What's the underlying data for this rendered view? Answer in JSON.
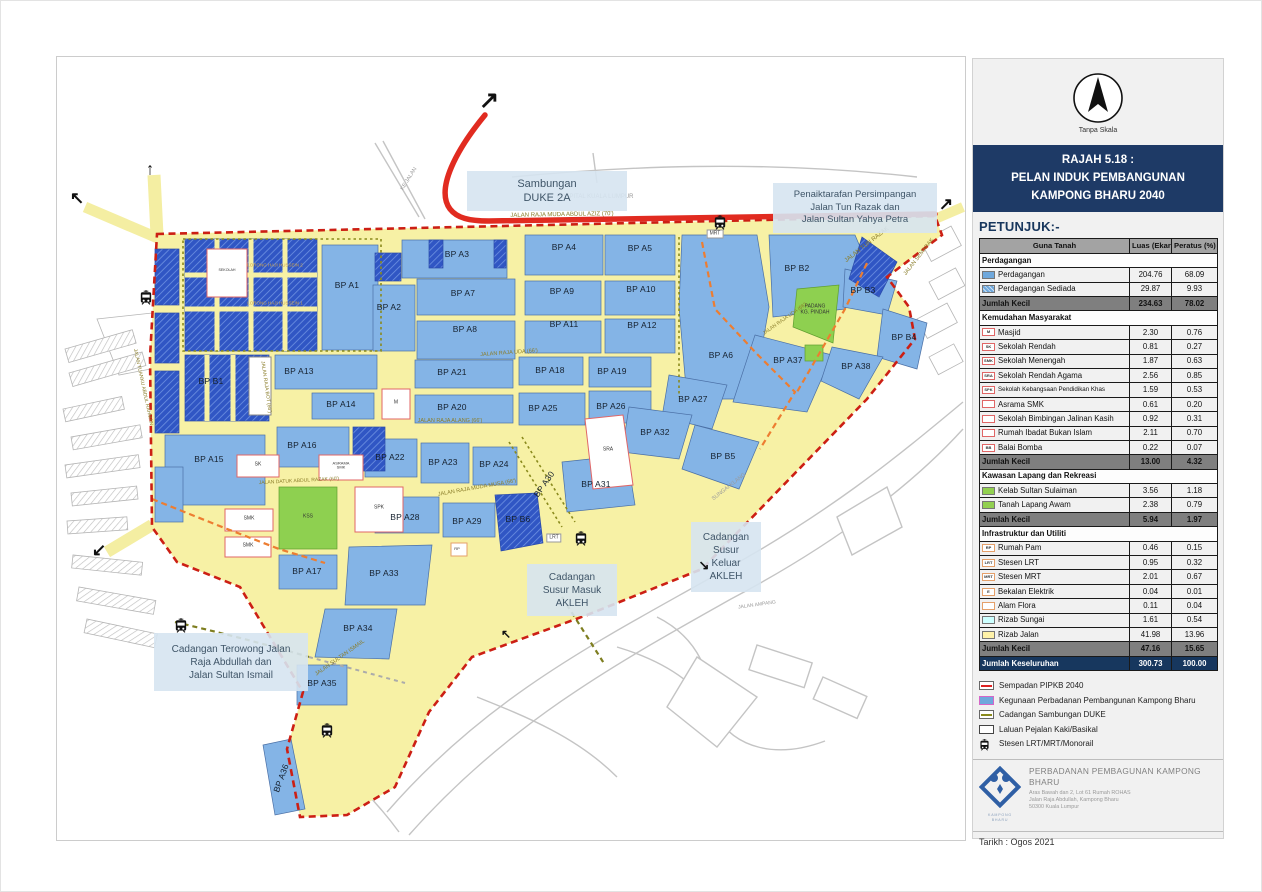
{
  "panel": {
    "scale_note": "Tanpa Skala",
    "title_lines": [
      "RAJAH 5.18 :",
      "PELAN INDUK PEMBANGUNAN",
      "KAMPONG BHARU 2040"
    ],
    "legend_heading": "PETUNJUK:-",
    "table": {
      "headers": [
        "Guna Tanah",
        "Luas (Ekar)",
        "Peratus (%)"
      ],
      "rows": [
        {
          "type": "section",
          "label": "Perdagangan"
        },
        {
          "type": "item",
          "swatch": {
            "style": "solid",
            "color": "#6fa8dc"
          },
          "label": "Perdagangan",
          "luas": "204.76",
          "peratus": "68.09"
        },
        {
          "type": "item",
          "swatch": {
            "style": "hatch",
            "color": "#6fa8dc"
          },
          "label": "Perdagangan Sediada",
          "luas": "29.87",
          "peratus": "9.93"
        },
        {
          "type": "subtotal",
          "label": "Jumlah Kecil",
          "luas": "234.63",
          "peratus": "78.02"
        },
        {
          "type": "section",
          "label": "Kemudahan Masyarakat"
        },
        {
          "type": "item",
          "swatch": {
            "style": "box",
            "border": "#e06666",
            "text": "M"
          },
          "label": "Masjid",
          "luas": "2.30",
          "peratus": "0.76"
        },
        {
          "type": "item",
          "swatch": {
            "style": "box",
            "border": "#e06666",
            "text": "SK"
          },
          "label": "Sekolah Rendah",
          "luas": "0.81",
          "peratus": "0.27"
        },
        {
          "type": "item",
          "swatch": {
            "style": "box",
            "border": "#e06666",
            "text": "SMK"
          },
          "label": "Sekolah Menengah",
          "luas": "1.87",
          "peratus": "0.63"
        },
        {
          "type": "item",
          "swatch": {
            "style": "box",
            "border": "#e06666",
            "text": "SRA"
          },
          "label": "Sekolah Rendah Agama",
          "luas": "2.56",
          "peratus": "0.85"
        },
        {
          "type": "item",
          "swatch": {
            "style": "box",
            "border": "#e06666",
            "text": "SPK"
          },
          "label": "Sekolah Kebangsaan Pendidikan Khas",
          "small": true,
          "luas": "1.59",
          "peratus": "0.53"
        },
        {
          "type": "item",
          "swatch": {
            "style": "box",
            "border": "#e06666",
            "text": ""
          },
          "label": "Asrama SMK",
          "luas": "0.61",
          "peratus": "0.20"
        },
        {
          "type": "item",
          "swatch": {
            "style": "box",
            "border": "#e06666",
            "text": ""
          },
          "label": "Sekolah Bimbingan Jalinan Kasih",
          "luas": "0.92",
          "peratus": "0.31"
        },
        {
          "type": "item",
          "swatch": {
            "style": "box",
            "border": "#e06666",
            "text": ""
          },
          "label": "Rumah Ibadat Bukan Islam",
          "luas": "2.11",
          "peratus": "0.70"
        },
        {
          "type": "item",
          "swatch": {
            "style": "box",
            "border": "#e06666",
            "text": "BB"
          },
          "label": "Balai Bomba",
          "luas": "0.22",
          "peratus": "0.07"
        },
        {
          "type": "subtotal",
          "label": "Jumlah Kecil",
          "luas": "13.00",
          "peratus": "4.32"
        },
        {
          "type": "section",
          "label": "Kawasan Lapang dan Rekreasi"
        },
        {
          "type": "item",
          "swatch": {
            "style": "solid",
            "color": "#92d050"
          },
          "label": "Kelab Sultan Sulaiman",
          "luas": "3.56",
          "peratus": "1.18"
        },
        {
          "type": "item",
          "swatch": {
            "style": "solid",
            "color": "#92d050"
          },
          "label": "Tanah Lapang Awam",
          "luas": "2.38",
          "peratus": "0.79"
        },
        {
          "type": "subtotal",
          "label": "Jumlah Kecil",
          "luas": "5.94",
          "peratus": "1.97"
        },
        {
          "type": "section",
          "label": "Infrastruktur dan Utiliti"
        },
        {
          "type": "item",
          "swatch": {
            "style": "box",
            "border": "#e5a06a",
            "text": "RP"
          },
          "label": "Rumah Pam",
          "luas": "0.46",
          "peratus": "0.15"
        },
        {
          "type": "item",
          "swatch": {
            "style": "box",
            "border": "#e5a06a",
            "text": "LRT"
          },
          "label": "Stesen LRT",
          "luas": "0.95",
          "peratus": "0.32"
        },
        {
          "type": "item",
          "swatch": {
            "style": "box",
            "border": "#e5a06a",
            "text": "MRT"
          },
          "label": "Stesen MRT",
          "luas": "2.01",
          "peratus": "0.67"
        },
        {
          "type": "item",
          "swatch": {
            "style": "box",
            "border": "#e5a06a",
            "text": "E"
          },
          "label": "Bekalan Elektrik",
          "luas": "0.04",
          "peratus": "0.01"
        },
        {
          "type": "item",
          "swatch": {
            "style": "box",
            "border": "#e5a06a",
            "text": ""
          },
          "label": "Alam Flora",
          "luas": "0.11",
          "peratus": "0.04"
        },
        {
          "type": "item",
          "swatch": {
            "style": "solid",
            "color": "#ccffff"
          },
          "label": "Rizab Sungai",
          "luas": "1.61",
          "peratus": "0.54"
        },
        {
          "type": "item",
          "swatch": {
            "style": "solid",
            "color": "#fff2a8"
          },
          "label": "Rizab Jalan",
          "luas": "41.98",
          "peratus": "13.96"
        },
        {
          "type": "subtotal",
          "label": "Jumlah Kecil",
          "luas": "47.16",
          "peratus": "15.65"
        },
        {
          "type": "total",
          "label": "Jumlah Keseluruhan",
          "luas": "300.73",
          "peratus": "100.00"
        }
      ]
    },
    "symbols": [
      {
        "icon": "dash-red",
        "label": "Sempadan PIPKB 2040"
      },
      {
        "icon": "fill-blue",
        "label": "Kegunaan Perbadanan Pembangunan Kampong Bharu"
      },
      {
        "icon": "dash-olive",
        "label": "Cadangan Sambungan DUKE"
      },
      {
        "icon": "white-box",
        "label": "Laluan Pejalan Kaki/Basikal"
      },
      {
        "icon": "train",
        "label": "Stesen LRT/MRT/Monorail"
      }
    ],
    "org": {
      "name": "PERBADANAN PEMBAGUNAN KAMPONG BHARU",
      "address_lines": [
        "Aras Bawah dan 2, Lot 61 Rumah ROHAS",
        "Jalan Raja Abdullah, Kampong Bharu",
        "50300 Kuala Lumpur"
      ],
      "logo_sub": "KAMPONG BHARU"
    },
    "date_label": "Tarikh : Ogos 2021"
  },
  "map": {
    "zones": [
      {
        "label": "BP A1",
        "x": 290,
        "y": 228
      },
      {
        "label": "BP A2",
        "x": 332,
        "y": 250
      },
      {
        "label": "BP A3",
        "x": 400,
        "y": 197
      },
      {
        "label": "BP A4",
        "x": 507,
        "y": 190
      },
      {
        "label": "BP A5",
        "x": 583,
        "y": 191
      },
      {
        "label": "BP A6",
        "x": 664,
        "y": 298
      },
      {
        "label": "BP A7",
        "x": 406,
        "y": 236
      },
      {
        "label": "BP A8",
        "x": 408,
        "y": 272
      },
      {
        "label": "BP A9",
        "x": 505,
        "y": 234
      },
      {
        "label": "BP A10",
        "x": 584,
        "y": 232
      },
      {
        "label": "BP A11",
        "x": 507,
        "y": 267
      },
      {
        "label": "BP A12",
        "x": 585,
        "y": 268
      },
      {
        "label": "BP A13",
        "x": 242,
        "y": 314
      },
      {
        "label": "BP A14",
        "x": 284,
        "y": 347
      },
      {
        "label": "BP A15",
        "x": 152,
        "y": 402
      },
      {
        "label": "BP A16",
        "x": 245,
        "y": 388
      },
      {
        "label": "BP A17",
        "x": 250,
        "y": 514
      },
      {
        "label": "BP A18",
        "x": 493,
        "y": 313
      },
      {
        "label": "BP A19",
        "x": 555,
        "y": 314
      },
      {
        "label": "BP A20",
        "x": 395,
        "y": 350
      },
      {
        "label": "BP A21",
        "x": 395,
        "y": 315
      },
      {
        "label": "BP A22",
        "x": 333,
        "y": 400
      },
      {
        "label": "BP A23",
        "x": 386,
        "y": 405
      },
      {
        "label": "BP A24",
        "x": 437,
        "y": 407
      },
      {
        "label": "BP A25",
        "x": 486,
        "y": 351
      },
      {
        "label": "BP A26",
        "x": 554,
        "y": 349
      },
      {
        "label": "BP A27",
        "x": 636,
        "y": 342
      },
      {
        "label": "BP A28",
        "x": 348,
        "y": 460
      },
      {
        "label": "BP A29",
        "x": 410,
        "y": 464
      },
      {
        "label": "BP A30",
        "x": 487,
        "y": 427,
        "rot": -55
      },
      {
        "label": "BP A31",
        "x": 539,
        "y": 427
      },
      {
        "label": "BP A32",
        "x": 598,
        "y": 375
      },
      {
        "label": "BP A33",
        "x": 327,
        "y": 516
      },
      {
        "label": "BP A34",
        "x": 301,
        "y": 571
      },
      {
        "label": "BP A35",
        "x": 265,
        "y": 626
      },
      {
        "label": "BP A36",
        "x": 224,
        "y": 721,
        "rot": -70
      },
      {
        "label": "BP A37",
        "x": 731,
        "y": 303
      },
      {
        "label": "BP A38",
        "x": 799,
        "y": 309
      },
      {
        "label": "BP B1",
        "x": 154,
        "y": 324
      },
      {
        "label": "BP B2",
        "x": 740,
        "y": 211
      },
      {
        "label": "BP B3",
        "x": 806,
        "y": 233
      },
      {
        "label": "BP B4",
        "x": 847,
        "y": 280
      },
      {
        "label": "BP B5",
        "x": 666,
        "y": 399
      },
      {
        "label": "BP B6",
        "x": 461,
        "y": 462
      }
    ],
    "facility_labels": [
      {
        "lines": [
          "M"
        ],
        "x": 339,
        "y": 346,
        "size": 5
      },
      {
        "lines": [
          "SK"
        ],
        "x": 201,
        "y": 408,
        "size": 5
      },
      {
        "lines": [
          "ASRAMA",
          "SMK"
        ],
        "x": 284,
        "y": 409,
        "size": 4
      },
      {
        "lines": [
          "SMK"
        ],
        "x": 192,
        "y": 462,
        "size": 5
      },
      {
        "lines": [
          "SMK"
        ],
        "x": 191,
        "y": 489,
        "size": 5
      },
      {
        "lines": [
          "KSS"
        ],
        "x": 251,
        "y": 460,
        "size": 5
      },
      {
        "lines": [
          "SPK"
        ],
        "x": 322,
        "y": 451,
        "size": 5
      },
      {
        "lines": [
          "SRA"
        ],
        "x": 551,
        "y": 393,
        "size": 5
      },
      {
        "lines": [
          "RP"
        ],
        "x": 400,
        "y": 492,
        "size": 4
      },
      {
        "lines": [
          "SEKOLAH"
        ],
        "x": 170,
        "y": 214,
        "size": 3.6
      },
      {
        "lines": [
          "PADANG",
          "KG.  PINDAH"
        ],
        "x": 758,
        "y": 253,
        "size": 5
      }
    ],
    "road_labels": [
      {
        "text": "JALAN RAJA MUDA ABDUL AZIZ (70')",
        "x": 505,
        "y": 158,
        "rot": -1,
        "size": 6,
        "color": "olive"
      },
      {
        "text": "JALAN TUN RAZAK",
        "x": 810,
        "y": 188,
        "rot": -38,
        "size": 6,
        "color": "olive"
      },
      {
        "text": "JALAN SEMARAK",
        "x": 862,
        "y": 200,
        "rot": -52,
        "size": 5.5,
        "color": "olive"
      },
      {
        "text": "JALAN RAJA UDA (66')",
        "x": 452,
        "y": 296,
        "rot": -4,
        "size": 5.5,
        "color": "olive"
      },
      {
        "text": "JALAN RAJA UDA (66')",
        "x": 728,
        "y": 262,
        "rot": -35,
        "size": 5,
        "color": "olive"
      },
      {
        "text": "JALAN RAJA ALANG (66')",
        "x": 393,
        "y": 364,
        "rot": 0,
        "size": 5.5,
        "color": "olive"
      },
      {
        "text": "JALAN RAJA MUDA MUSA (66')",
        "x": 420,
        "y": 431,
        "rot": -10,
        "size": 5.5,
        "color": "olive"
      },
      {
        "text": "JALAN DATUK ABDUL RAZAK (60')",
        "x": 242,
        "y": 424,
        "rot": -3,
        "size": 5,
        "color": "olive"
      },
      {
        "text": "JALAN TUANKU ABDUL RAHMAN",
        "x": 86,
        "y": 330,
        "rot": 78,
        "size": 5,
        "color": "olive"
      },
      {
        "text": "JALAN RAJA BOT (66')",
        "x": 209,
        "y": 330,
        "rot": 82,
        "size": 5,
        "color": "olive"
      },
      {
        "text": "LORONG HAJI HUSSEIN 2",
        "x": 218,
        "y": 208,
        "rot": 0,
        "size": 4.5,
        "color": "tan"
      },
      {
        "text": "LORONG HAJI HUSSEIN 1",
        "x": 218,
        "y": 246,
        "rot": 0,
        "size": 4.5,
        "color": "tan"
      },
      {
        "text": "JALAN SULTAN ISMAIL",
        "x": 283,
        "y": 601,
        "rot": -35,
        "size": 5.5,
        "color": "olive"
      },
      {
        "text": "SUNGAI KLANG",
        "x": 672,
        "y": 430,
        "rot": -38,
        "size": 5.5,
        "color": "gray"
      },
      {
        "text": "HOSPITAL KUALA LUMPUR",
        "x": 538,
        "y": 140,
        "rot": 0,
        "size": 6,
        "color": "gray"
      },
      {
        "text": "KE JALAN",
        "x": 352,
        "y": 122,
        "rot": -58,
        "size": 5.5,
        "color": "gray"
      },
      {
        "text": "JALAN AMPANG",
        "x": 700,
        "y": 548,
        "rot": -8,
        "size": 5,
        "color": "gray"
      }
    ],
    "callouts": [
      {
        "lines": [
          "Sambungan",
          "DUKE 2A"
        ],
        "x": 410,
        "y": 114,
        "w": 160,
        "h": 40,
        "size": 11
      },
      {
        "lines": [
          "Penaiktarafan Persimpangan",
          "Jalan Tun Razak dan",
          "Jalan Sultan Yahya Petra"
        ],
        "x": 716,
        "y": 126,
        "w": 164,
        "h": 50,
        "size": 9.5
      },
      {
        "lines": [
          "Cadangan",
          "Susur",
          "Keluar",
          "AKLEH"
        ],
        "x": 634,
        "y": 465,
        "w": 70,
        "h": 70,
        "size": 10
      },
      {
        "lines": [
          "Cadangan",
          "Susur Masuk",
          "AKLEH"
        ],
        "x": 470,
        "y": 507,
        "w": 90,
        "h": 52,
        "size": 10
      },
      {
        "lines": [
          "Cadangan Terowong Jalan",
          "Raja Abdullah dan",
          "Jalan Sultan Ismail"
        ],
        "x": 97,
        "y": 576,
        "w": 154,
        "h": 58,
        "size": 10
      }
    ],
    "stations": [
      {
        "x": 82,
        "y": 233
      },
      {
        "x": 656,
        "y": 158
      },
      {
        "x": 517,
        "y": 474
      },
      {
        "x": 117,
        "y": 561
      },
      {
        "x": 263,
        "y": 666
      }
    ],
    "tags": [
      {
        "text": "MRT",
        "x": 658,
        "y": 177
      },
      {
        "text": "LRT",
        "x": 497,
        "y": 481
      }
    ],
    "arrows": [
      {
        "glyph": "↗",
        "x": 432,
        "y": 44,
        "size": 24
      },
      {
        "glyph": "↑",
        "x": 93,
        "y": 112,
        "size": 17
      },
      {
        "glyph": "↖",
        "x": 20,
        "y": 141,
        "size": 17
      },
      {
        "glyph": "↙",
        "x": 42,
        "y": 493,
        "size": 17
      },
      {
        "glyph": "↗",
        "x": 889,
        "y": 147,
        "size": 17
      },
      {
        "glyph": "↘",
        "x": 647,
        "y": 508,
        "size": 13
      },
      {
        "glyph": "↖",
        "x": 449,
        "y": 577,
        "size": 12
      }
    ]
  }
}
